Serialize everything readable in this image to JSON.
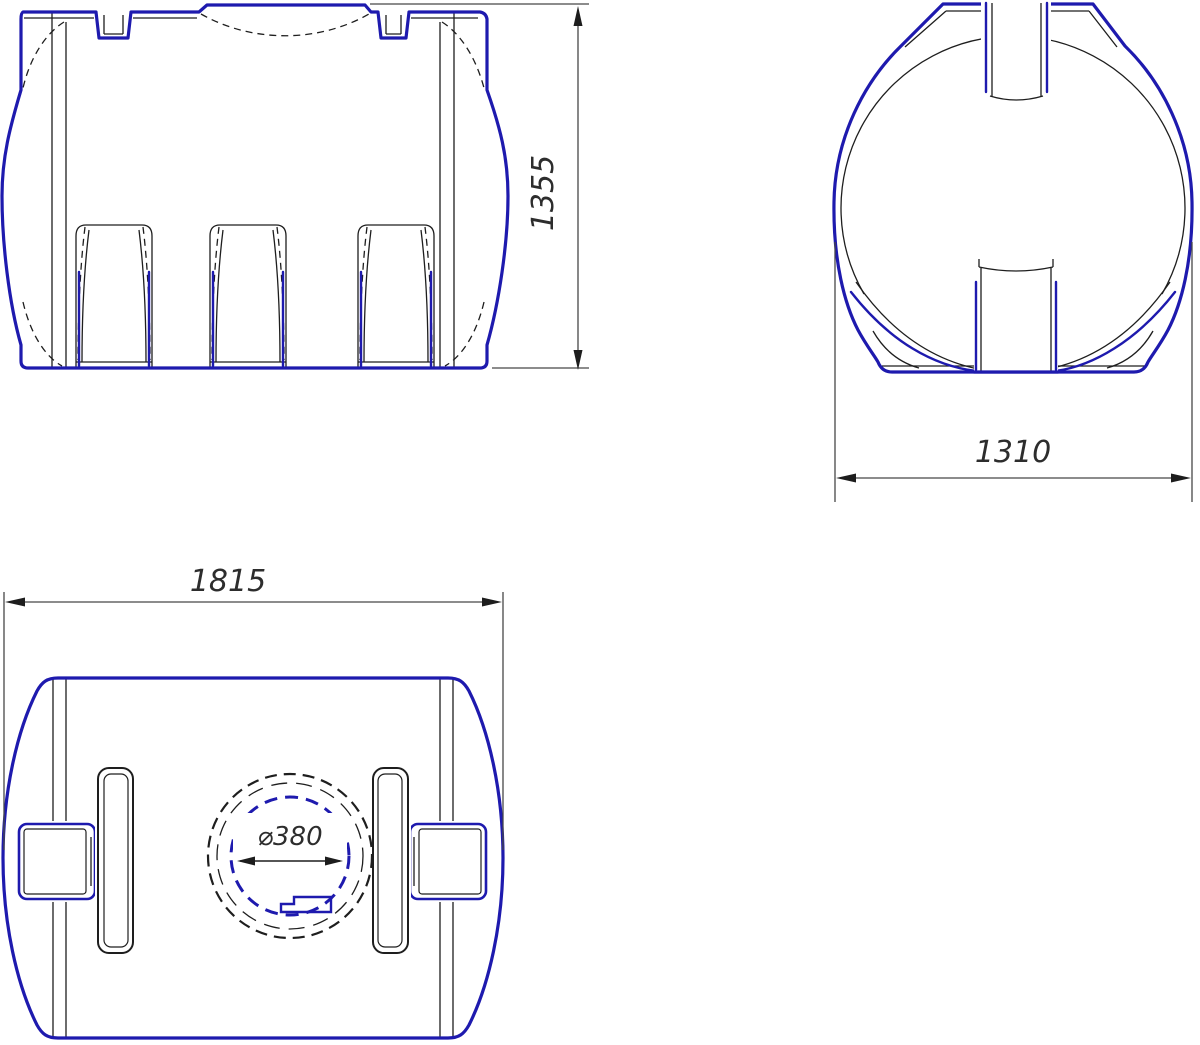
{
  "drawing": {
    "views": {
      "front": {
        "height_dimension": "1355"
      },
      "end": {
        "width_dimension": "1310"
      },
      "top": {
        "length_dimension": "1815",
        "manhole_dimension": "⌀380"
      }
    },
    "colors": {
      "outline_blue": "#1e1aae",
      "linework_black": "#1e1e1e",
      "dimension_gray": "#474747",
      "background": "#ffffff"
    }
  }
}
